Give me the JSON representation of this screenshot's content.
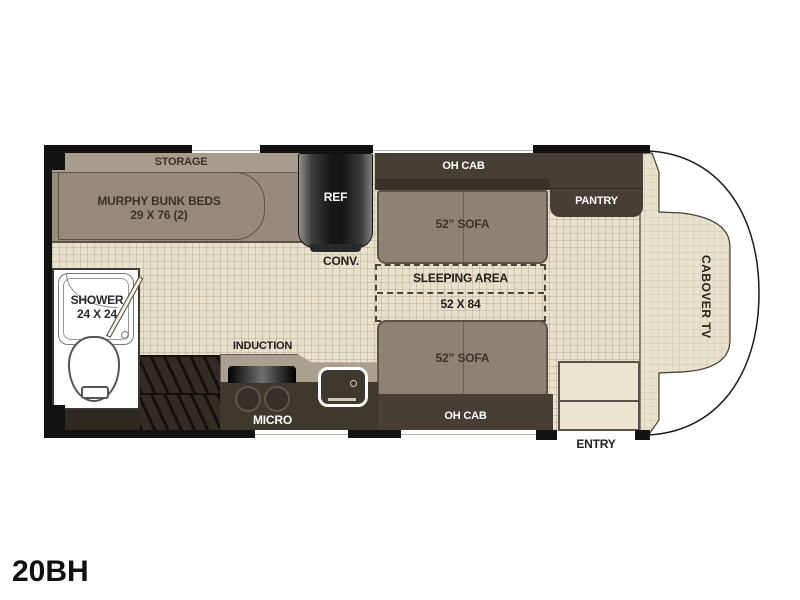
{
  "model": "20BH",
  "floorplan": {
    "bedroom": {
      "storage": "STORAGE",
      "murphy_beds": "MURPHY BUNK BEDS",
      "murphy_dims": "29 X 76 (2)"
    },
    "kitchen": {
      "ref": "REF",
      "conv": "CONV.",
      "induction": "INDUCTION",
      "micro": "MICRO"
    },
    "living": {
      "oh_cab_top": "OH CAB",
      "sofa_top": "52” SOFA",
      "pantry": "PANTRY",
      "sleeping_area": "SLEEPING AREA",
      "sleeping_dims": "52 X 84",
      "sofa_bottom": "52” SOFA",
      "oh_cab_bottom": "OH CAB"
    },
    "bathroom": {
      "shower": "SHOWER",
      "shower_dims": "24 X 24"
    },
    "cab": {
      "cabover_tv": "CABOVER TV",
      "entry": "ENTRY"
    }
  },
  "colors": {
    "floor": "#e8e1cc",
    "wall": "#121212",
    "cabinet_dark": "#473f36",
    "furniture_taupe": "#8e8274",
    "counter": "#aba08f",
    "text_dark": "#2e2922",
    "text_light": "#ffffff"
  }
}
